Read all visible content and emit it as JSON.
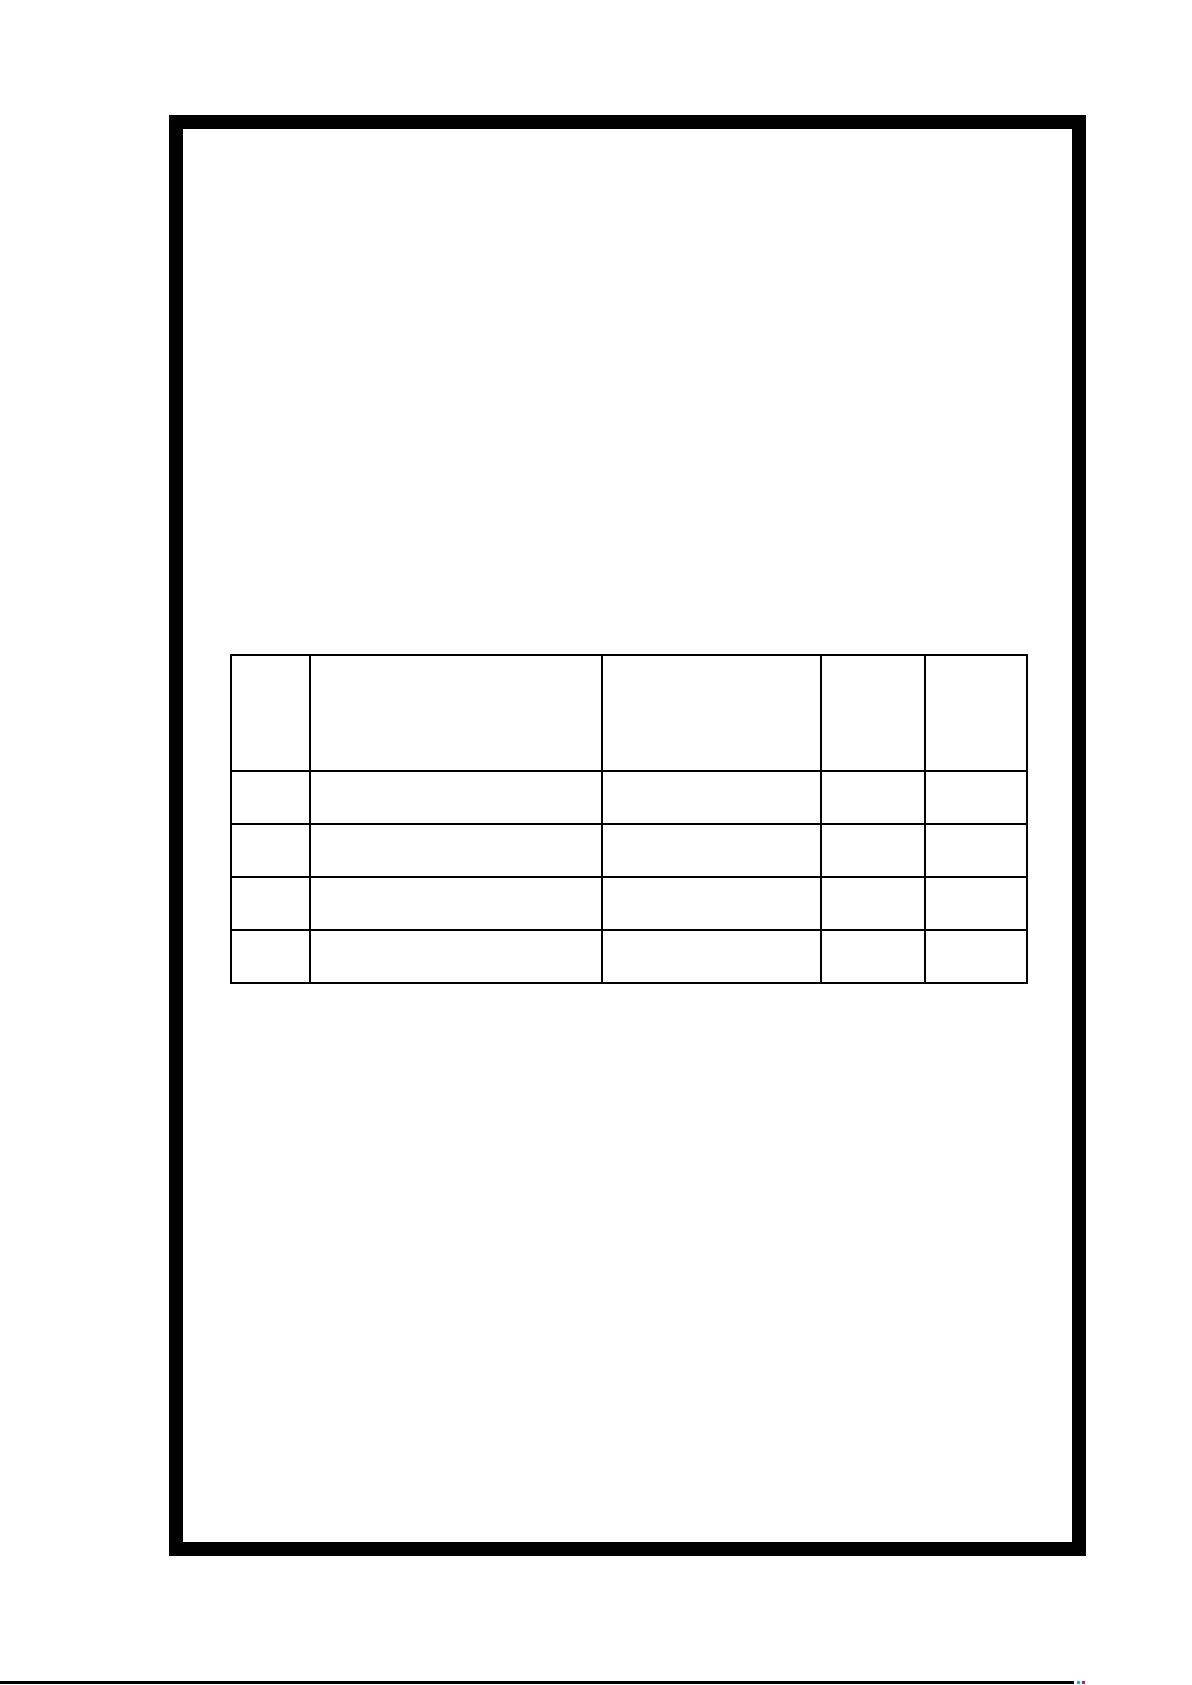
{
  "page": {
    "background_color": "#ffffff",
    "frame_border_color": "#000000",
    "table_border_color": "#000000",
    "bottom_rule_color": "#000000",
    "artifact_cyan_color": "#29b2c9",
    "artifact_magenta_color": "#b0188f"
  },
  "table": {
    "header": [
      "",
      "",
      "",
      "",
      ""
    ],
    "rows": [
      [
        "",
        "",
        "",
        "",
        ""
      ],
      [
        "",
        "",
        "",
        "",
        ""
      ],
      [
        "",
        "",
        "",
        "",
        ""
      ],
      [
        "",
        "",
        "",
        "",
        ""
      ]
    ]
  }
}
